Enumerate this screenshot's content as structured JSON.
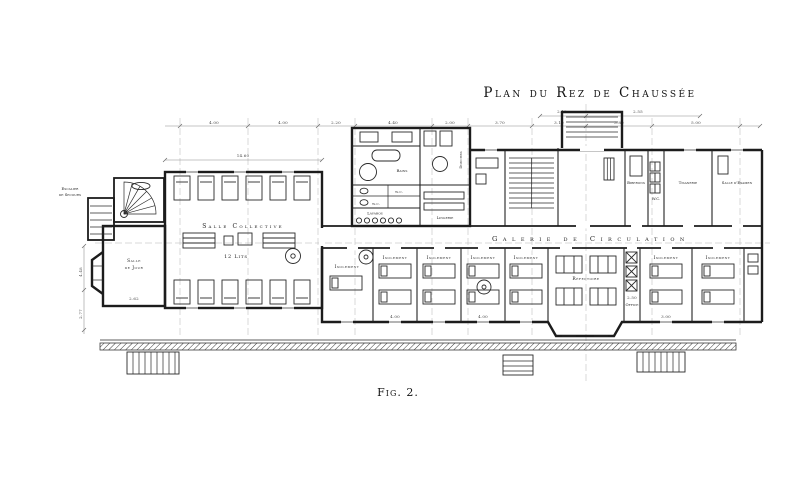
{
  "figure": {
    "title": "Plan du Rez de Chaussée",
    "caption": "Fig. 2."
  },
  "rooms": {
    "salle_collective": "Salle Collective",
    "lits": "12 Lits",
    "salle_de_jour_1": "Salle",
    "salle_de_jour_2": "de Jour",
    "escalier_1": "Escalier",
    "escalier_2": "de Secours",
    "bains": "Bains",
    "wc": "w.c.",
    "lavabos": "Lavabos",
    "douches": "Douches",
    "lingerie": "Lingerie",
    "galerie": "Galerie de Circulation",
    "isolement": "Isolement",
    "refectoire": "Réfectoire",
    "office": "Office",
    "biberons": "Biberons",
    "wc2": "W.C.",
    "tisanerie": "Tisanerie",
    "salle_examen": "Salle d'Examen"
  },
  "dims": {
    "d1": "4.00",
    "d2": "4.00",
    "d3": "2.20",
    "d4": "4.40",
    "d5": "2.00",
    "d6": "3.70",
    "d7": "3.10",
    "d8": "3.80",
    "d9": "5.00",
    "d10": "14.60",
    "d11": "2.62",
    "d12": "4.48",
    "d13": "2.50",
    "d14": "4.00",
    "d15": "4.00",
    "d16": "3.00",
    "d17": "2.77",
    "d18": "2.15",
    "d19": "2.55"
  },
  "colors": {
    "ink": "#1c1c1c",
    "paper": "#ffffff",
    "faint": "#999999"
  }
}
